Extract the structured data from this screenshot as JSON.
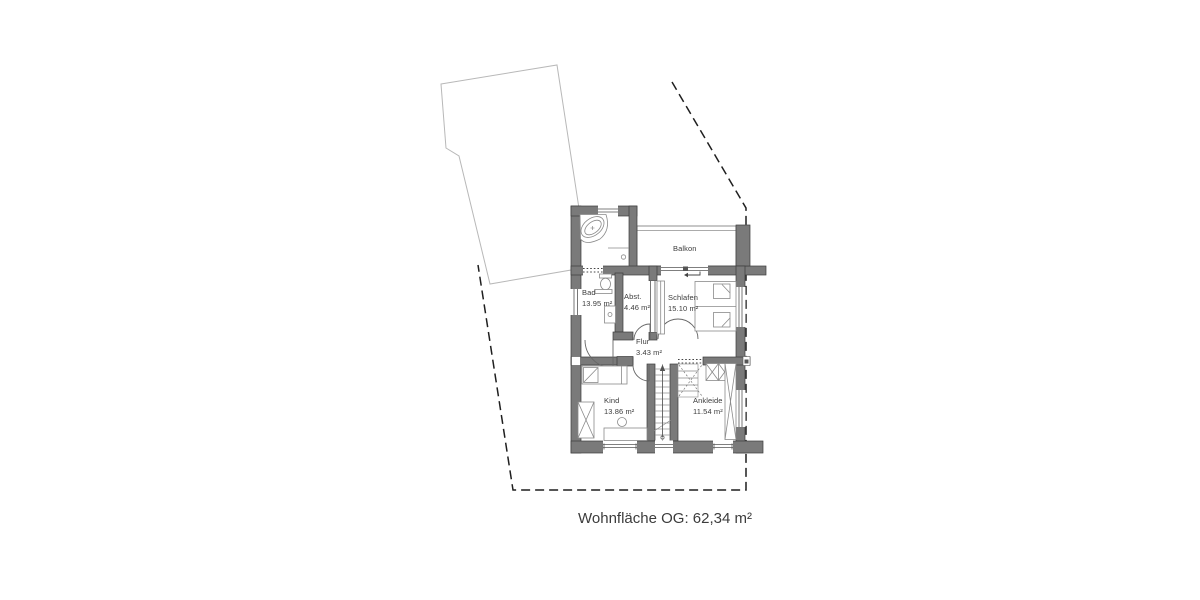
{
  "plan": {
    "caption": "Wohnfläche OG: 62,34 m²",
    "balcony_label": "Balkon",
    "rooms": [
      {
        "id": "bad",
        "name": "Bad",
        "area": "13.95 m²"
      },
      {
        "id": "abst",
        "name": "Abst.",
        "area": "4.46 m²"
      },
      {
        "id": "schlafen",
        "name": "Schlafen",
        "area": "15.10 m²"
      },
      {
        "id": "flur",
        "name": "Flur",
        "area": "3.43 m²"
      },
      {
        "id": "kind",
        "name": "Kind",
        "area": "13.86 m²"
      },
      {
        "id": "ankleide",
        "name": "Ankleide",
        "area": "11.54 m²"
      }
    ],
    "colors": {
      "wall": "#7a7a7a",
      "wall_outline": "#3d3d3d",
      "boundary": "#1f1f1f",
      "neighbor_outline": "#b8b8b8",
      "text": "#3c3c3c",
      "background": "#ffffff"
    }
  }
}
